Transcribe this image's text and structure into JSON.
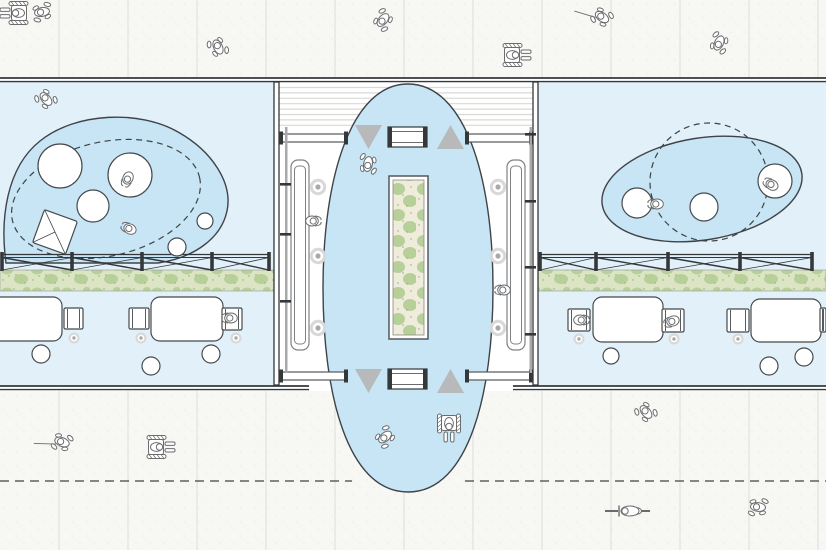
{
  "canvas": {
    "width": 826,
    "height": 550
  },
  "palette": {
    "paper": "#ffffff",
    "sidewalk": "#f7f7f4",
    "speckle": "#ebebe7",
    "joint": "#e2e2df",
    "room_fill": "#e2f0f9",
    "zone_fill": "#c7e5f4",
    "outline_ink": "#3f4347",
    "wall_dark": "#34383b",
    "wall_light": "#a9a9a9",
    "triangle_gray": "#b7b9bb",
    "figure_stroke": "#6a6c6e",
    "furniture_stroke": "#45494c",
    "veg_bg": "#dbe5c4",
    "veg_blob": "#b7d099",
    "veg_dot": "#8fa874",
    "planter_bg": "#efecdb",
    "ring_fill": "#d8d8d8",
    "ring_dot": "#a9a9a9",
    "bench_stroke": "#7f8285"
  },
  "sidewalks": {
    "top": {
      "x": 0,
      "y": 0,
      "w": 826,
      "h": 78
    },
    "bottom": {
      "x": 0,
      "y": 391,
      "w": 826,
      "h": 159
    },
    "joint_xs": [
      59,
      128,
      197,
      266,
      335,
      404,
      473,
      542,
      611,
      680,
      749,
      818
    ],
    "guide_line": {
      "y": 481,
      "segments": [
        [
          0,
          352
        ],
        [
          465,
          826
        ]
      ],
      "dash": "9 6"
    }
  },
  "building": {
    "rooms": [
      {
        "name": "room-left",
        "x": 0,
        "y": 82,
        "w": 274,
        "h": 303
      },
      {
        "name": "room-right",
        "x": 538,
        "y": 82,
        "w": 288,
        "h": 303
      }
    ],
    "corridor": {
      "x": 279,
      "y": 82,
      "w": 259,
      "h": 303
    },
    "decking": {
      "x1": 279,
      "x2": 533,
      "y0": 87.5,
      "step": 5.4,
      "count": 8
    },
    "top_wall": {
      "x1": 0,
      "x2": 826,
      "y": 78,
      "y2": 81.6
    },
    "bottom_wall": {
      "segments": [
        [
          0,
          309
        ],
        [
          513,
          826
        ]
      ],
      "y": 386,
      "y2": 389.6
    },
    "dark_walls": [
      {
        "x": 274,
        "y": 82,
        "w": 5,
        "h": 303
      },
      {
        "x": 533,
        "y": 82,
        "w": 5,
        "h": 303
      }
    ],
    "light_walls": [
      {
        "x": 285,
        "y": 127,
        "w": 2.5,
        "h": 246
      },
      {
        "x": 529.5,
        "y": 127,
        "w": 2.5,
        "h": 246
      }
    ],
    "wall_ticks": [
      {
        "x": 280,
        "y": 183
      },
      {
        "x": 280,
        "y": 233
      },
      {
        "x": 280,
        "y": 300
      },
      {
        "x": 525,
        "y": 133
      },
      {
        "x": 525,
        "y": 200
      },
      {
        "x": 525,
        "y": 266
      },
      {
        "x": 525,
        "y": 333
      }
    ]
  },
  "zones": {
    "left_blob_path": "M 6,263 C 0,220 6,168 40,141 C 76,112 140,110 178,132 C 212,151 233,183 227,211 C 221,239 193,258 158,263 Z",
    "right_ellipse": {
      "cx": 702,
      "cy": 189,
      "rx": 101,
      "ry": 51,
      "rot": -9
    },
    "corridor_path": "M 323,288 C 323,175 352,84 408,84 C 464,84 493,175 493,288 C 493,390 470,492 408,492 C 346,492 323,390 323,288 Z",
    "dashed_left": {
      "cx": 106,
      "cy": 199,
      "rx": 96,
      "ry": 57,
      "rot": -13
    },
    "dashed_right_circle": {
      "cx": 709,
      "cy": 182,
      "r": 59
    },
    "dash": "6 4.5"
  },
  "planter": {
    "outer": {
      "x": 389,
      "y": 176,
      "w": 39,
      "h": 163
    },
    "inner": {
      "x": 393,
      "y": 180,
      "w": 31,
      "h": 155
    }
  },
  "greens": [
    {
      "x": 0,
      "y": 270,
      "w": 274,
      "h": 21
    },
    {
      "x": 538,
      "y": 270,
      "w": 288,
      "h": 21
    }
  ],
  "fences": {
    "rail_y": 254.5,
    "rail_y2": 257.5,
    "brace_y": 270,
    "rows": [
      {
        "posts": [
          2,
          72,
          142,
          212,
          269
        ]
      },
      {
        "posts": [
          540,
          596,
          668,
          740,
          812
        ]
      }
    ]
  },
  "thresholds": {
    "bars": [
      {
        "x1": 280,
        "x2": 347,
        "y": 134
      },
      {
        "x1": 466,
        "x2": 532,
        "y": 134
      },
      {
        "x1": 280,
        "x2": 347,
        "y": 372
      },
      {
        "x1": 466,
        "x2": 532,
        "y": 372
      }
    ],
    "bar_h": 8,
    "mats": [
      {
        "x": 388,
        "y": 127
      },
      {
        "x": 388,
        "y": 369
      }
    ],
    "mat_w": 39,
    "mat_h": 20,
    "triangles": [
      {
        "dir": "down",
        "points": [
          [
            355,
            125
          ],
          [
            382,
            125
          ],
          [
            368.5,
            149
          ]
        ]
      },
      {
        "dir": "up",
        "points": [
          [
            437,
            149
          ],
          [
            464,
            149
          ],
          [
            450.5,
            125
          ]
        ]
      },
      {
        "dir": "down",
        "points": [
          [
            355,
            369
          ],
          [
            382,
            369
          ],
          [
            368.5,
            393
          ]
        ]
      },
      {
        "dir": "up",
        "points": [
          [
            437,
            393
          ],
          [
            464,
            393
          ],
          [
            450.5,
            369
          ]
        ]
      }
    ]
  },
  "benches": [
    {
      "x": 291,
      "y": 160,
      "w": 18,
      "h": 190
    },
    {
      "x": 507,
      "y": 160,
      "w": 18,
      "h": 190
    }
  ],
  "floor_rings_large": [
    {
      "x": 318,
      "y": 187
    },
    {
      "x": 318,
      "y": 256
    },
    {
      "x": 318,
      "y": 328
    },
    {
      "x": 498,
      "y": 187
    },
    {
      "x": 498,
      "y": 256
    },
    {
      "x": 498,
      "y": 328
    }
  ],
  "floor_rings_small": [
    {
      "x": 74,
      "y": 338
    },
    {
      "x": 141,
      "y": 338
    },
    {
      "x": 236,
      "y": 338
    },
    {
      "x": 579,
      "y": 339
    },
    {
      "x": 674,
      "y": 339
    },
    {
      "x": 738,
      "y": 339
    }
  ],
  "furniture": {
    "tables": [
      {
        "x": -28,
        "y": 297,
        "w": 90,
        "h": 44
      },
      {
        "x": 151,
        "y": 297,
        "w": 72,
        "h": 44
      },
      {
        "x": 593,
        "y": 297,
        "w": 70,
        "h": 45
      },
      {
        "x": 751,
        "y": 299,
        "w": 70,
        "h": 43
      }
    ],
    "chairs": [
      {
        "x": 64,
        "y": 308,
        "w": 19,
        "h": 21
      },
      {
        "x": 129,
        "y": 308,
        "w": 20,
        "h": 21
      },
      {
        "x": 222,
        "y": 308,
        "w": 20,
        "h": 22
      },
      {
        "x": 568,
        "y": 309,
        "w": 22,
        "h": 22
      },
      {
        "x": 662,
        "y": 309,
        "w": 22,
        "h": 23
      },
      {
        "x": 727,
        "y": 309,
        "w": 22,
        "h": 23
      },
      {
        "x": 820,
        "y": 308,
        "w": 6,
        "h": 24
      }
    ],
    "stools": [
      {
        "x": 41,
        "y": 354,
        "r": 9
      },
      {
        "x": 151,
        "y": 366,
        "r": 9
      },
      {
        "x": 211,
        "y": 354,
        "r": 9
      },
      {
        "x": 611,
        "y": 356,
        "r": 8
      },
      {
        "x": 769,
        "y": 366,
        "r": 9
      },
      {
        "x": 804,
        "y": 357,
        "r": 9
      }
    ],
    "round_tables": [
      {
        "x": 60,
        "y": 166,
        "r": 22
      },
      {
        "x": 130,
        "y": 175,
        "r": 22
      },
      {
        "x": 93,
        "y": 206,
        "r": 16
      },
      {
        "x": 205,
        "y": 221,
        "r": 8
      },
      {
        "x": 177,
        "y": 247,
        "r": 9
      },
      {
        "x": 637,
        "y": 203,
        "r": 15
      },
      {
        "x": 704,
        "y": 207,
        "r": 14
      },
      {
        "x": 775,
        "y": 181,
        "r": 17
      }
    ],
    "square_tables": [
      {
        "cx": 55,
        "cy": 232,
        "size": 35,
        "rot": 20
      }
    ]
  },
  "people": [
    {
      "type": "wheelchair",
      "x": 18,
      "y": 13,
      "rot": 180
    },
    {
      "type": "walking",
      "x": 42,
      "y": 12,
      "rot": 170
    },
    {
      "type": "walking",
      "x": 218,
      "y": 47,
      "rot": -115
    },
    {
      "type": "walking",
      "x": 383,
      "y": 20,
      "rot": 130
    },
    {
      "type": "wheelchair",
      "x": 513,
      "y": 55,
      "rot": 0
    },
    {
      "type": "cane",
      "x": 602,
      "y": 17,
      "rot": 215
    },
    {
      "type": "walking",
      "x": 719,
      "y": 43,
      "rot": 115
    },
    {
      "type": "walking",
      "x": 46,
      "y": 99,
      "rot": -130
    },
    {
      "type": "sitting",
      "x": 128,
      "y": 178,
      "rot": 115
    },
    {
      "type": "sitting",
      "x": 130,
      "y": 229,
      "rot": 205
    },
    {
      "type": "sitting",
      "x": 231,
      "y": 318,
      "rot": 180
    },
    {
      "type": "walking",
      "x": 368,
      "y": 164,
      "rot": 100
    },
    {
      "type": "sitting",
      "x": 312,
      "y": 221,
      "rot": 0
    },
    {
      "type": "sitting",
      "x": 504,
      "y": 290,
      "rot": 180
    },
    {
      "type": "sitting",
      "x": 657,
      "y": 204,
      "rot": 180
    },
    {
      "type": "sitting",
      "x": 772,
      "y": 185,
      "rot": 210
    },
    {
      "type": "sitting",
      "x": 580,
      "y": 320,
      "rot": 0
    },
    {
      "type": "sitting",
      "x": 673,
      "y": 321,
      "rot": 160
    },
    {
      "type": "walking",
      "x": 385,
      "y": 437,
      "rot": 140
    },
    {
      "type": "wheelchair",
      "x": 449,
      "y": 424,
      "rot": 90
    },
    {
      "type": "cane",
      "x": 62,
      "y": 442,
      "rot": 200
    },
    {
      "type": "wheelchair",
      "x": 157,
      "y": 447,
      "rot": 0
    },
    {
      "type": "walking",
      "x": 646,
      "y": 412,
      "rot": -130
    },
    {
      "type": "cyclist",
      "x": 628,
      "y": 511,
      "rot": 180
    },
    {
      "type": "walking",
      "x": 758,
      "y": 507,
      "rot": 185
    }
  ]
}
